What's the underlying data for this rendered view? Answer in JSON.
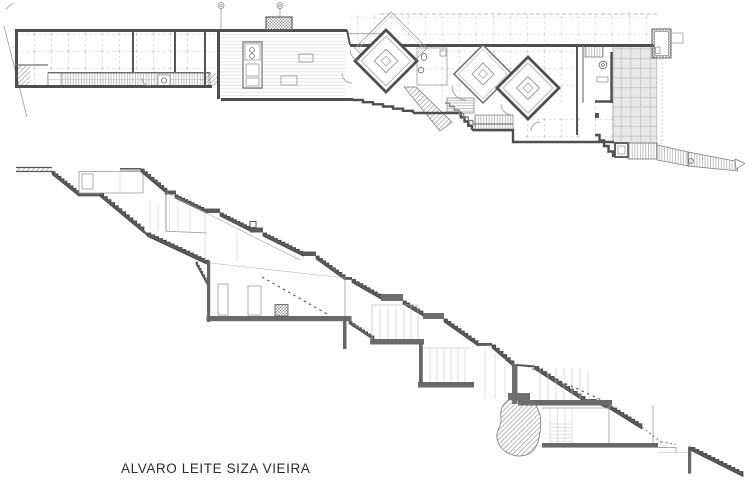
{
  "title": {
    "text": "ALVARO LEITE SIZA VIEIRA",
    "color": "#2a2a2a"
  },
  "sheet": {
    "background": "#ffffff",
    "drawings": [
      {
        "name": "floor-plan",
        "position": "top"
      },
      {
        "name": "longitudinal-section",
        "position": "bottom"
      }
    ]
  },
  "palette": {
    "wall_dark": "#4f4f4f",
    "stair_band": "#5a5a5a",
    "slab_gray": "#696969",
    "thin_line": "#9a9a9a",
    "hatch_line": "#8d8d8d",
    "terrace_fill": "#e8e8e8",
    "grid_dash": "#c2c2c2"
  }
}
